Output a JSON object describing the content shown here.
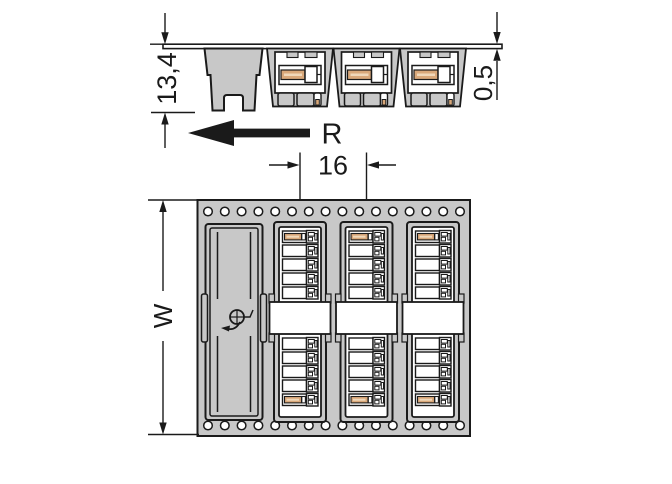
{
  "drawing": {
    "colors": {
      "outline": "#1a1a1a",
      "tape_fill": "#c8c8c8",
      "contact_orange": "#d9a87a",
      "orange_highlight": "#f0d8ba",
      "background": "#ffffff"
    },
    "side_view": {
      "height_dimension": "13,4",
      "tape_thickness_dimension": "0,5"
    },
    "feed": {
      "unreeling_direction_label": "R",
      "pocket_pitch_dimension": "16"
    },
    "top_view": {
      "tape_width_dimension": "W",
      "sprocket_holes_per_row": 16,
      "pockets_visible": 4,
      "connectors_visible": 3,
      "contacts_per_connector": 10
    }
  }
}
